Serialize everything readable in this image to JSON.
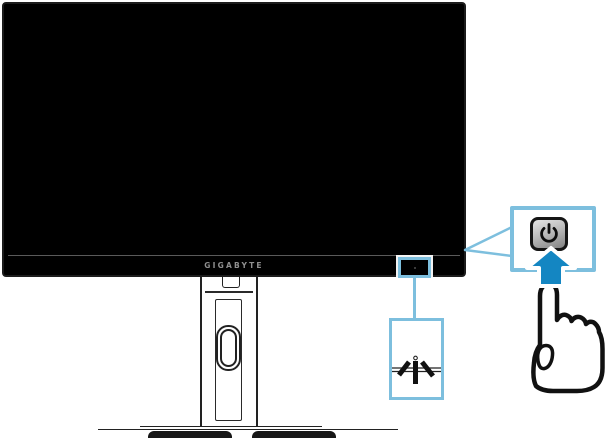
{
  "monitor": {
    "brand_label": "GIGABYTE",
    "screen_color": "#000000",
    "bezel_divider_color": "#5a5a5a",
    "logo_color": "#8f8f8f"
  },
  "callouts": {
    "accent_color": "#7dbfde",
    "power": {
      "icon": "power-icon",
      "button_fill": "#b9b9b9",
      "symbol_color": "#0d0d0d"
    },
    "joystick": {
      "icon": "joystick-icon",
      "stroke_color": "#111111"
    }
  },
  "press_arrow": {
    "icon": "up-arrow-icon",
    "color": "#1486c2",
    "outline_color": "#ffffff"
  },
  "hand": {
    "icon": "pointing-hand-icon",
    "outline_color": "#111111"
  }
}
